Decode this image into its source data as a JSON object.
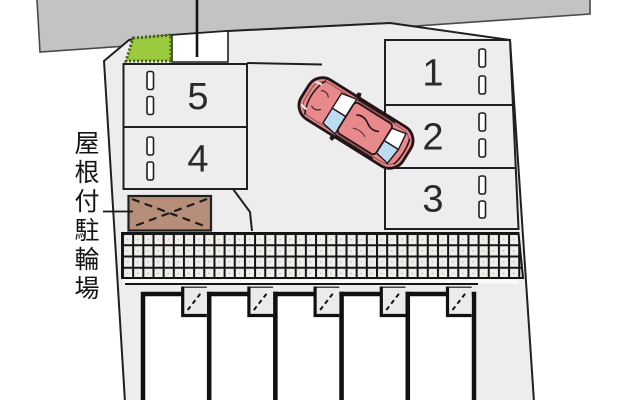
{
  "diagram": {
    "type": "parking-site-plan",
    "bicycle_parking_label": "屋根付駐輪場",
    "left_spaces": [
      "5",
      "4"
    ],
    "right_spaces": [
      "1",
      "2",
      "3"
    ],
    "car_icon": "car-top-view",
    "colors": {
      "road": "#c3c3c3",
      "site": "#ededed",
      "outline": "#1f1f1f",
      "planting": "#9bca3e",
      "planting_edge": "#44601a",
      "shed": "#b78e79",
      "walkway_cell": "#efeeeb",
      "walkway_grid": "#131313",
      "car_body": "#e8898b",
      "car_glass": "#bcdcf2",
      "car_outline": "#241518",
      "unit_fill": "#ffffff",
      "wall": "#101010"
    }
  }
}
